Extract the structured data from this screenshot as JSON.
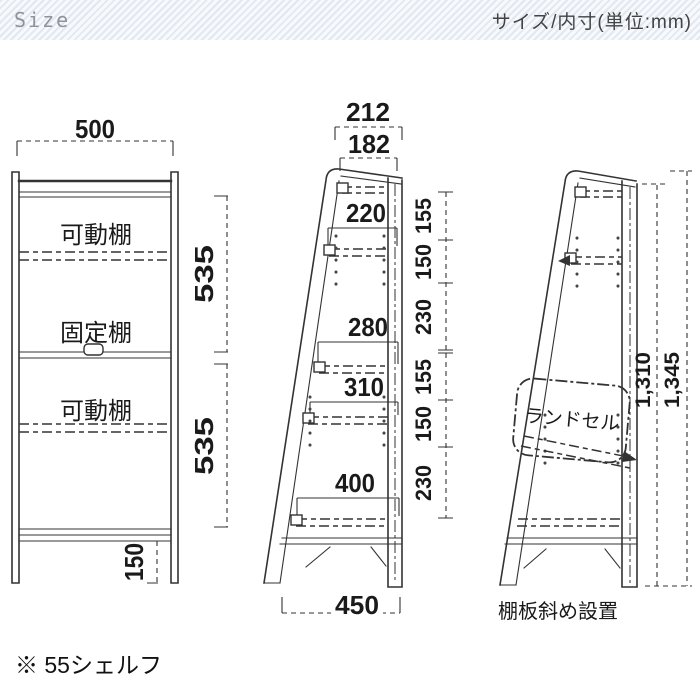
{
  "header": {
    "left": "Size",
    "right": "サイズ/内寸(単位:mm)"
  },
  "front_view": {
    "label_movable_top": "可動棚",
    "label_fixed": "固定棚",
    "label_movable_bottom": "可動棚",
    "dim_width": "500",
    "dim_upper_section": "535",
    "dim_lower_section": "535",
    "dim_leg_height": "150"
  },
  "side_view": {
    "dim_top_outer": "212",
    "dim_top_inner": "182",
    "dim_shelf_1": "220",
    "dim_shelf_2": "280",
    "dim_shelf_3": "310",
    "dim_shelf_4": "400",
    "dim_bottom_width": "450",
    "right_dims": [
      "155",
      "150",
      "230",
      "155",
      "150",
      "230"
    ]
  },
  "tilt_view": {
    "bag_label": "ランドセル",
    "dim_height_inner": "1,310",
    "dim_height_outer": "1,345",
    "caption": "棚板斜め設置"
  },
  "footnote": "※ 55シェルフ",
  "colors": {
    "line": "#333333",
    "header_stripe": "#e2e8f1",
    "header_text": "#434343",
    "size_text": "#8d949c"
  }
}
